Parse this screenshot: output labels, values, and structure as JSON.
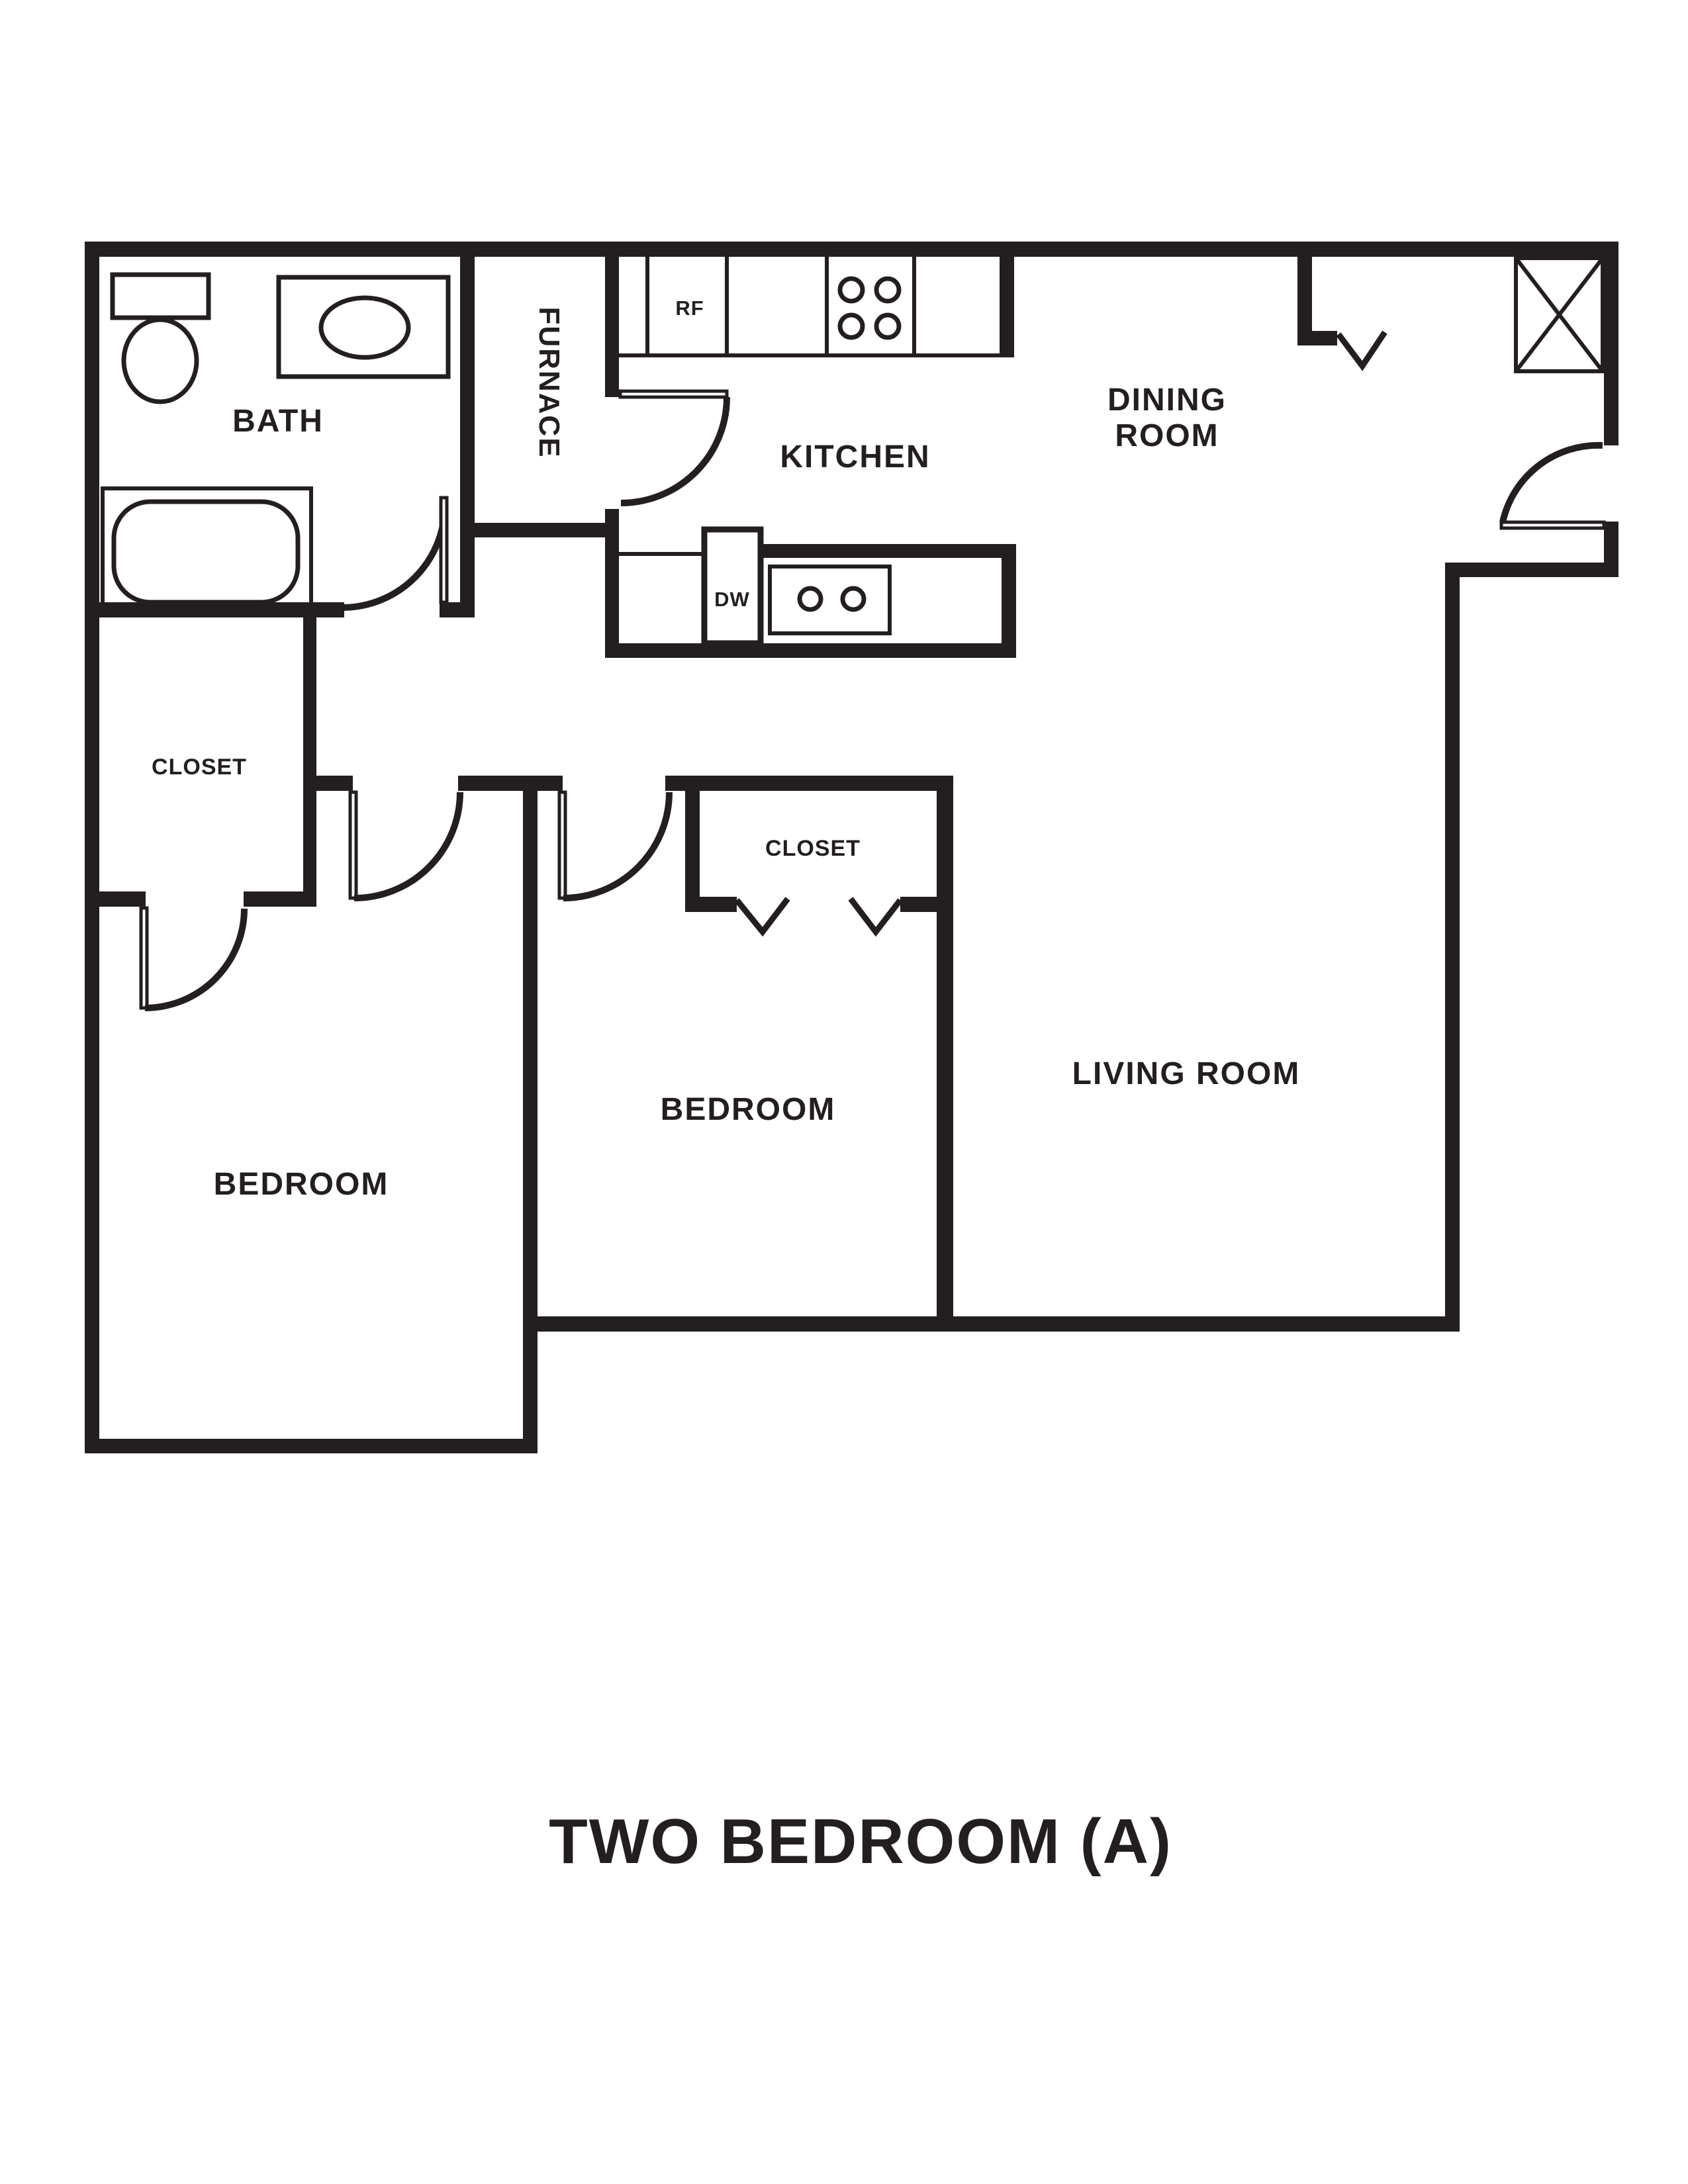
{
  "plan": {
    "title": "TWO BEDROOM (A)",
    "ink_color": "#231f20",
    "background_color": "#ffffff",
    "rooms": {
      "bath": "BATH",
      "furnace": "FURNACE",
      "kitchen": "KITCHEN",
      "dining_line1": "DINING",
      "dining_line2": "ROOM",
      "closet_left": "CLOSET",
      "closet_middle": "CLOSET",
      "bedroom_left": "BEDROOM",
      "bedroom_middle": "BEDROOM",
      "living_room": "LIVING ROOM"
    },
    "appliances": {
      "refrigerator": "RF",
      "dishwasher": "DW"
    }
  }
}
